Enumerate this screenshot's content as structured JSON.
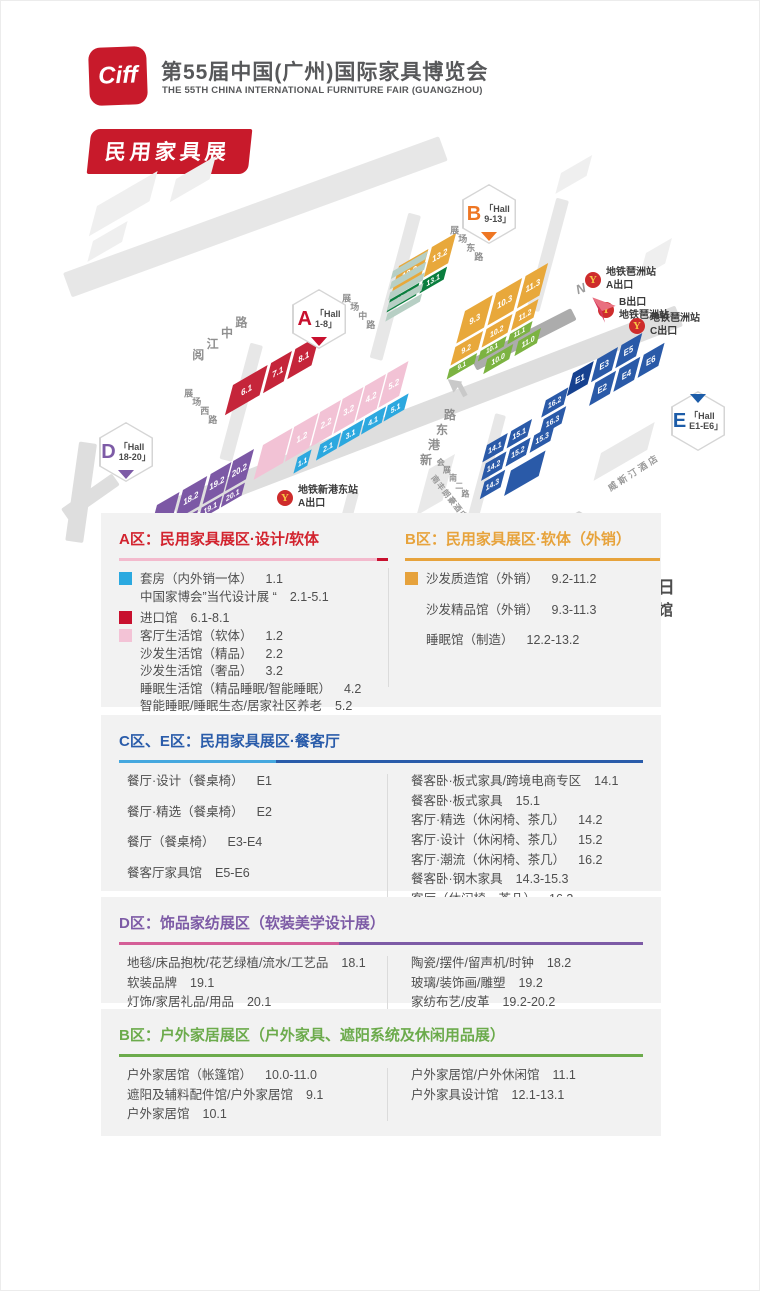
{
  "header": {
    "logo_text": "Ciff",
    "title_cn": "第55届中国(广州)国际家具博览会",
    "title_en": "THE 55TH CHINA INTERNATIONAL FURNITURE FAIR (GUANGZHOU)",
    "banner": "民用家具展"
  },
  "icons": {
    "metro_glyph": "Y"
  },
  "map": {
    "compass_label": "N",
    "roads": [
      {
        "x": 62,
        "y": 122,
        "w": 400,
        "h": 26,
        "angle": -20,
        "c": "#E7E7E7"
      },
      {
        "x": 170,
        "y": 348,
        "w": 540,
        "h": 22,
        "angle": -21,
        "c": "#DEDEDE"
      },
      {
        "x": 420,
        "y": 65,
        "w": 150,
        "h": 13,
        "angle": 105,
        "c": "#E7E7E7"
      },
      {
        "x": 262,
        "y": 195,
        "w": 120,
        "h": 13,
        "angle": 105,
        "c": "#E7E7E7"
      },
      {
        "x": 568,
        "y": 50,
        "w": 115,
        "h": 13,
        "angle": 105,
        "c": "#E7E7E7"
      },
      {
        "x": 358,
        "y": 342,
        "w": 112,
        "h": 11,
        "angle": 105,
        "c": "#E7E7E7"
      },
      {
        "x": 505,
        "y": 265,
        "w": 118,
        "h": 11,
        "angle": 105,
        "c": "#E7E7E7"
      },
      {
        "x": 470,
        "y": 208,
        "w": 112,
        "h": 13,
        "angle": -27,
        "c": "#ACACAC"
      },
      {
        "x": 96,
        "y": 293,
        "w": 100,
        "h": 18,
        "angle": 98,
        "c": "#DEDEDE"
      },
      {
        "x": 60,
        "y": 358,
        "w": 62,
        "h": 14,
        "angle": -35,
        "c": "#DEDEDE"
      }
    ],
    "bg_blocks": [
      {
        "x": 96,
        "y": 55,
        "w": 70,
        "h": 26,
        "c": "#EFEFEF"
      },
      {
        "x": 92,
        "y": 90,
        "w": 40,
        "h": 18,
        "c": "#EFEFEF"
      },
      {
        "x": 175,
        "y": 28,
        "w": 46,
        "h": 20,
        "c": "#EFEFEF"
      },
      {
        "x": 560,
        "y": 22,
        "w": 36,
        "h": 18,
        "c": "#EFEFEF"
      },
      {
        "x": 645,
        "y": 102,
        "w": 30,
        "h": 22,
        "c": "#EFEFEF"
      },
      {
        "x": 200,
        "y": 406,
        "w": 44,
        "h": 18,
        "c": "#EFEFEF"
      },
      {
        "x": 272,
        "y": 416,
        "w": 44,
        "h": 18,
        "c": "#EFEFEF"
      },
      {
        "x": 344,
        "y": 428,
        "w": 44,
        "h": 18,
        "c": "#EFEFEF"
      },
      {
        "x": 600,
        "y": 302,
        "w": 62,
        "h": 24,
        "c": "#E9E9E9"
      },
      {
        "x": 428,
        "y": 318,
        "w": 30,
        "h": 40,
        "c": "#E9E9E9"
      }
    ],
    "clusters": [
      {
        "name": "a-red",
        "x": 232,
        "y": 234,
        "blocks": [
          {
            "t": "6.1",
            "x": 0,
            "y": 0,
            "w": 40,
            "h": 26,
            "c": "#C5253A"
          },
          {
            "t": "7.1",
            "x": 44,
            "y": 0,
            "w": 24,
            "h": 26,
            "c": "#C5253A"
          },
          {
            "t": "8.1",
            "x": 72,
            "y": 0,
            "w": 28,
            "h": 26,
            "c": "#C5253A"
          }
        ]
      },
      {
        "name": "a-pink-cyan",
        "x": 262,
        "y": 294,
        "blocks": [
          {
            "t": "",
            "x": 0,
            "y": 0,
            "w": 34,
            "h": 30,
            "c": "#F2C2D5"
          },
          {
            "t": "1.2",
            "x": 36,
            "y": 0,
            "w": 28,
            "h": 30,
            "c": "#F2C2D5"
          },
          {
            "t": "2.2",
            "x": 66,
            "y": 0,
            "w": 24,
            "h": 30,
            "c": "#F2C2D5"
          },
          {
            "t": "3.2",
            "x": 92,
            "y": 0,
            "w": 24,
            "h": 30,
            "c": "#F2C2D5"
          },
          {
            "t": "4.2",
            "x": 118,
            "y": 0,
            "w": 24,
            "h": 30,
            "c": "#F2C2D5"
          },
          {
            "t": "5.2",
            "x": 144,
            "y": 0,
            "w": 24,
            "h": 30,
            "c": "#F2C2D5"
          },
          {
            "t": "1.1",
            "x": 52,
            "y": 33,
            "w": 16,
            "h": 14,
            "c": "#2CA8DF",
            "fs": 7.5
          },
          {
            "t": "2.1",
            "x": 78,
            "y": 33,
            "w": 24,
            "h": 14,
            "c": "#2CA8DF",
            "fs": 8
          },
          {
            "t": "3.1",
            "x": 104,
            "y": 33,
            "w": 24,
            "h": 14,
            "c": "#2CA8DF",
            "fs": 8
          },
          {
            "t": "4.1",
            "x": 130,
            "y": 33,
            "w": 24,
            "h": 14,
            "c": "#2CA8DF",
            "fs": 8
          },
          {
            "t": "5.1",
            "x": 156,
            "y": 33,
            "w": 24,
            "h": 14,
            "c": "#2CA8DF",
            "fs": 8
          }
        ]
      },
      {
        "name": "b-west",
        "x": 398,
        "y": 115,
        "blocks": [
          {
            "t": "12.2",
            "x": 0,
            "y": 0,
            "w": 34,
            "h": 26,
            "c": "#E8A83B"
          },
          {
            "t": "13.2",
            "x": 38,
            "y": 0,
            "w": 28,
            "h": 26,
            "c": "#E8A83B"
          },
          {
            "t": "12.1",
            "x": 0,
            "y": 29,
            "w": 34,
            "h": 11,
            "c": "#0A7E3E",
            "fs": 8
          },
          {
            "t": "13.1",
            "x": 38,
            "y": 29,
            "w": 28,
            "h": 11,
            "c": "#0A7E3E",
            "fs": 8
          }
        ]
      },
      {
        "name": "b-main",
        "x": 464,
        "y": 160,
        "blocks": [
          {
            "t": "9.3",
            "x": 0,
            "y": 0,
            "w": 32,
            "h": 28,
            "c": "#E8A83B"
          },
          {
            "t": "10.3",
            "x": 36,
            "y": 0,
            "w": 30,
            "h": 28,
            "c": "#E8A83B"
          },
          {
            "t": "11.3",
            "x": 70,
            "y": 0,
            "w": 26,
            "h": 28,
            "c": "#E8A83B"
          },
          {
            "t": "9.2",
            "x": 0,
            "y": 31,
            "w": 32,
            "h": 16,
            "c": "#E8A83B",
            "fs": 8
          },
          {
            "t": "10.2",
            "x": 36,
            "y": 31,
            "w": 30,
            "h": 16,
            "c": "#E8A83B",
            "fs": 8
          },
          {
            "t": "11.2",
            "x": 70,
            "y": 31,
            "w": 26,
            "h": 16,
            "c": "#E8A83B",
            "fs": 8
          },
          {
            "t": "9.1",
            "x": 0,
            "y": 50,
            "w": 32,
            "h": 9,
            "c": "#7CB342",
            "fs": 7
          },
          {
            "t": "10.1",
            "x": 36,
            "y": 50,
            "w": 30,
            "h": 9,
            "c": "#7CB342",
            "fs": 7
          },
          {
            "t": "11.1",
            "x": 70,
            "y": 50,
            "w": 26,
            "h": 9,
            "c": "#7CB342",
            "fs": 7
          },
          {
            "t": "10.0",
            "x": 48,
            "y": 62,
            "w": 30,
            "h": 13,
            "c": "#7CB342",
            "fs": 8
          },
          {
            "t": "11.0",
            "x": 84,
            "y": 62,
            "w": 26,
            "h": 13,
            "c": "#7CB342",
            "fs": 8
          }
        ]
      },
      {
        "name": "e-halls",
        "x": 572,
        "y": 222,
        "blocks": [
          {
            "t": "E1",
            "x": 0,
            "y": 0,
            "w": 24,
            "h": 20,
            "c": "#16418F"
          },
          {
            "t": "E3",
            "x": 28,
            "y": 0,
            "w": 24,
            "h": 20,
            "c": "#2A5AA8"
          },
          {
            "t": "E5",
            "x": 56,
            "y": 0,
            "w": 24,
            "h": 20,
            "c": "#2A5AA8"
          },
          {
            "t": "E2",
            "x": 34,
            "y": 23,
            "w": 24,
            "h": 20,
            "c": "#2A5AA8"
          },
          {
            "t": "E4",
            "x": 62,
            "y": 23,
            "w": 24,
            "h": 20,
            "c": "#2A5AA8"
          },
          {
            "t": "E6",
            "x": 90,
            "y": 23,
            "w": 24,
            "h": 20,
            "c": "#2A5AA8"
          }
        ]
      },
      {
        "name": "c-halls",
        "x": 486,
        "y": 294,
        "blocks": [
          {
            "t": "14.1",
            "x": 0,
            "y": 0,
            "w": 24,
            "h": 15,
            "c": "#2A5AA8",
            "fs": 8
          },
          {
            "t": "15.1",
            "x": 28,
            "y": 0,
            "w": 24,
            "h": 15,
            "c": "#2A5AA8",
            "fs": 8
          },
          {
            "t": "16.2",
            "x": 64,
            "y": -11,
            "w": 26,
            "h": 15,
            "c": "#2A5AA8",
            "fs": 8
          },
          {
            "t": "16.3",
            "x": 68,
            "y": 7,
            "w": 26,
            "h": 15,
            "c": "#2A5AA8",
            "fs": 8
          },
          {
            "t": "14.2",
            "x": 5,
            "y": 18,
            "w": 24,
            "h": 15,
            "c": "#2A5AA8",
            "fs": 8
          },
          {
            "t": "15.2",
            "x": 33,
            "y": 18,
            "w": 24,
            "h": 15,
            "c": "#2A5AA8",
            "fs": 8,
            "cl": "hl"
          },
          {
            "t": "15.3",
            "x": 61,
            "y": 18,
            "w": 24,
            "h": 15,
            "c": "#2A5AA8",
            "fs": 8
          },
          {
            "t": "14.3",
            "x": 10,
            "y": 36,
            "w": 24,
            "h": 15,
            "c": "#2A5AA8",
            "fs": 8
          },
          {
            "t": "",
            "x": 42,
            "y": 40,
            "w": 40,
            "h": 22,
            "c": "#2A5AA8"
          }
        ]
      },
      {
        "name": "d-halls",
        "x": 156,
        "y": 354,
        "blocks": [
          {
            "t": "",
            "x": 0,
            "y": 0,
            "w": 26,
            "h": 40,
            "c": "#7C58A5"
          },
          {
            "t": "18.2",
            "x": 30,
            "y": 0,
            "w": 28,
            "h": 26,
            "c": "#7C58A5"
          },
          {
            "t": "19.2",
            "x": 62,
            "y": 0,
            "w": 24,
            "h": 26,
            "c": "#7C58A5"
          },
          {
            "t": "20.2",
            "x": 88,
            "y": 0,
            "w": 24,
            "h": 26,
            "c": "#7C58A5"
          },
          {
            "t": "18.1",
            "x": 30,
            "y": 29,
            "w": 28,
            "h": 11,
            "c": "#7C58A5",
            "fs": 8
          },
          {
            "t": "19.1",
            "x": 62,
            "y": 29,
            "w": 24,
            "h": 11,
            "c": "#7C58A5",
            "fs": 8
          },
          {
            "t": "20.1",
            "x": 88,
            "y": 29,
            "w": 24,
            "h": 11,
            "c": "#7C58A5",
            "fs": 8
          }
        ]
      },
      {
        "name": "sage-stack",
        "x": 392,
        "y": 120,
        "blocks": [
          {
            "t": "",
            "x": 0,
            "y": 0,
            "w": 40,
            "h": 7,
            "c": "#B7CFC4"
          },
          {
            "t": "",
            "x": 2,
            "y": 10,
            "w": 40,
            "h": 7,
            "c": "#B7CFC4"
          },
          {
            "t": "",
            "x": 4,
            "y": 20,
            "w": 40,
            "h": 7,
            "c": "#B7CFC4"
          },
          {
            "t": "",
            "x": 6,
            "y": 30,
            "w": 40,
            "h": 7,
            "c": "#B7CFC4"
          },
          {
            "t": "",
            "x": 8,
            "y": 40,
            "w": 40,
            "h": 7,
            "c": "#B7CFC4"
          }
        ]
      }
    ],
    "streets": [
      {
        "t": "阅江中路",
        "x": 188,
        "y": 202,
        "angle": -37,
        "fs": 12,
        "ls": 6
      },
      {
        "t": "展场西路",
        "x": 190,
        "y": 233,
        "angle": 48,
        "fs": 9,
        "ls": 3
      },
      {
        "t": "展场中路",
        "x": 348,
        "y": 138,
        "angle": 48,
        "fs": 9,
        "ls": 3
      },
      {
        "t": "展场东路",
        "x": 456,
        "y": 70,
        "angle": 48,
        "fs": 9,
        "ls": 3
      },
      {
        "t": "新港东路",
        "x": 416,
        "y": 312,
        "angle": -62,
        "fs": 12,
        "ls": 5
      },
      {
        "t": "会展南一路",
        "x": 300,
        "y": 380,
        "angle": 52,
        "fs": 8,
        "ls": 2
      },
      {
        "t": "会展南二路",
        "x": 442,
        "y": 304,
        "angle": 52,
        "fs": 8,
        "ls": 2
      }
    ],
    "buildings": [
      {
        "t": "南丰朗豪酒店",
        "x": 436,
        "y": 322,
        "angle": 52,
        "keep": true,
        "fs": 8,
        "ls": 1
      },
      {
        "t": "威斯汀酒店",
        "x": 604,
        "y": 332,
        "angle": -33,
        "keep": true,
        "fs": 9,
        "ls": 3
      }
    ],
    "badges": [
      {
        "letter": "A",
        "line1": "「Hall",
        "line2": "1-8」",
        "color": "#C8102E",
        "tri": "bottom",
        "x": 291,
        "y": 138
      },
      {
        "letter": "B",
        "line1": "「Hall",
        "line2": "9-13」",
        "color": "#EE7623",
        "tri": "bottom",
        "x": 461,
        "y": 33
      },
      {
        "letter": "C",
        "line1": "「Hall",
        "line2": "14-16」",
        "color": "#1C5CA8",
        "tri": "top",
        "x": 551,
        "y": 360
      },
      {
        "letter": "D",
        "line1": "「Hall",
        "line2": "18-20」",
        "color": "#7D5BA6",
        "tri": "bottom",
        "x": 98,
        "y": 271
      },
      {
        "letter": "E",
        "line1": "「Hall",
        "line2": "E1-E6」",
        "color": "#1C5CA8",
        "tri": "top",
        "x": 670,
        "y": 240
      }
    ],
    "metro": [
      {
        "l1": "地铁琶洲站",
        "l2": "A出口",
        "x": 584,
        "y": 116
      },
      {
        "l1": "B出口",
        "l2": "地铁琶洲站",
        "x": 597,
        "y": 146
      },
      {
        "l1": "地铁琶洲站",
        "l2": "C出口",
        "x": 628,
        "y": 162
      },
      {
        "l1": "地铁新港东站",
        "l2": "A出口",
        "x": 276,
        "y": 334
      },
      {
        "l1": "地铁新港东站",
        "l2": "F出口",
        "x": 333,
        "y": 364
      }
    ],
    "location": {
      "date": "2025年3月18-21日",
      "venue1": "广州琶洲·广交会展馆",
      "venue2": "保利世贸博览馆"
    }
  },
  "sections": {
    "a": {
      "title": "A区：民用家具展区·设计/软体",
      "color": "#D2232E",
      "underline": "linear-gradient(90deg,#F3BACD 0,#F3BACD 96%,#C8102E 96%)",
      "items": [
        {
          "swatch": "#2BA9E0",
          "label": "套房（内外销一体）",
          "num": "1.1"
        },
        {
          "label": "中国家博会”当代设计展 “",
          "num": "2.1-5.1"
        },
        {
          "swatch": "#C8102E",
          "label": "进口馆",
          "num": "6.1-8.1"
        },
        {
          "swatch": "#F3C3D6",
          "label": "客厅生活馆（软体）",
          "num": "1.2"
        },
        {
          "label": "沙发生活馆（精品）",
          "num": "2.2"
        },
        {
          "label": "沙发生活馆（奢品）",
          "num": "3.2"
        },
        {
          "label": "睡眠生活馆（精品睡眠/智能睡眠）",
          "num": "4.2"
        },
        {
          "label": "智能睡眠/睡眠生态/居家社区养老",
          "num": "5.2"
        }
      ]
    },
    "b": {
      "title": "B区：民用家具展区·软体（外销）",
      "color": "#E7A33C",
      "underline": "#E7A33C",
      "items": [
        {
          "swatch": "#E6A23C",
          "label": "沙发质造馆（外销）",
          "num": "9.2-11.2"
        },
        {
          "label": "沙发精品馆（外销）",
          "num": "9.3-11.3"
        },
        {
          "label": "睡眠馆（制造）",
          "num": "12.2-13.2"
        }
      ]
    },
    "ce": {
      "title": "C区、E区：民用家具展区·餐客厅",
      "color": "#2A5CAA",
      "underline": "linear-gradient(90deg,#45A8DF 0,#45A8DF 30%,#2A5CAA 30%)",
      "left": [
        {
          "label": "餐厅·设计（餐桌椅）",
          "num": "E1"
        },
        {
          "label": "餐厅·精选（餐桌椅）",
          "num": "E2"
        },
        {
          "label": "餐厅（餐桌椅）",
          "num": "E3-E4"
        },
        {
          "label": "餐客厅家具馆",
          "num": "E5-E6"
        }
      ],
      "right": [
        {
          "label": "餐客卧·板式家具/跨境电商专区",
          "num": "14.1"
        },
        {
          "label": "餐客卧·板式家具",
          "num": "15.1"
        },
        {
          "label": "客厅·精选（休闲椅、茶几）",
          "num": "14.2"
        },
        {
          "label": "客厅·设计（休闲椅、茶几）",
          "num": "15.2"
        },
        {
          "label": "客厅·潮流（休闲椅、茶几）",
          "num": "16.2"
        },
        {
          "label": "餐客卧·钢木家具",
          "num": "14.3-15.3"
        },
        {
          "label": "客厅（休闲椅、茶几）",
          "num": "16.3"
        }
      ]
    },
    "d": {
      "title": "D区：饰品家纺展区（软装美学设计展）",
      "color": "#7D5BA6",
      "underline": "linear-gradient(90deg,#D45E97 0,#D45E97 42%,#7D5BA6 42%)",
      "left": [
        {
          "label": "地毯/床品抱枕/花艺绿植/流水/工艺品",
          "num": "18.1"
        },
        {
          "label": "软装品牌",
          "num": "19.1"
        },
        {
          "label": "灯饰/家居礼品/用品",
          "num": "20.1"
        }
      ],
      "right": [
        {
          "label": "陶瓷/摆件/留声机/时钟",
          "num": "18.2"
        },
        {
          "label": "玻璃/装饰画/雕塑",
          "num": "19.2"
        },
        {
          "label": "家纺布艺/皮革",
          "num": "19.2-20.2"
        }
      ]
    },
    "out": {
      "title": "B区：户外家居展区（户外家具、遮阳系统及休闲用品展）",
      "color": "#6CAB4C",
      "underline": "#6CAB4C",
      "left": [
        {
          "label": "户外家居馆（帐篷馆）",
          "num": "10.0-11.0"
        },
        {
          "label": "遮阳及辅料配件馆/户外家居馆",
          "num": "9.1"
        },
        {
          "label": "户外家居馆",
          "num": "10.1"
        }
      ],
      "right": [
        {
          "label": "户外家居馆/户外休闲馆",
          "num": "11.1"
        },
        {
          "label": "户外家具设计馆",
          "num": "12.1-13.1"
        }
      ]
    }
  }
}
